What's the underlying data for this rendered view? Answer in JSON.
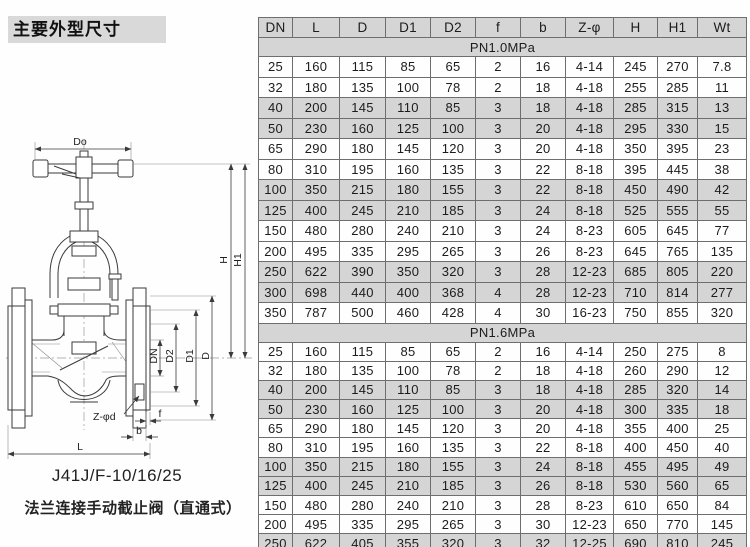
{
  "page": {
    "title": "主要外型尺寸"
  },
  "drawing": {
    "model": "J41J/F-10/16/25",
    "caption": "法兰连接手动截止阀（直通式）",
    "labels": {
      "do": "Do",
      "h": "H",
      "h1": "H1",
      "dn": "DN",
      "d2": "D2",
      "d1": "D1",
      "d": "D",
      "z_phi_d": "Z-φd",
      "f": "f",
      "b": "b",
      "l": "L"
    }
  },
  "table": {
    "columns": [
      "DN",
      "L",
      "D",
      "D1",
      "D2",
      "f",
      "b",
      "Z-φ",
      "H",
      "H1",
      "Wt"
    ],
    "sections": [
      {
        "label": "PN1.0MPa",
        "rows": [
          [
            "25",
            "160",
            "115",
            "85",
            "65",
            "2",
            "16",
            "4-14",
            "245",
            "270",
            "7.8"
          ],
          [
            "32",
            "180",
            "135",
            "100",
            "78",
            "2",
            "18",
            "4-18",
            "255",
            "285",
            "11"
          ],
          [
            "40",
            "200",
            "145",
            "110",
            "85",
            "3",
            "18",
            "4-18",
            "285",
            "315",
            "13"
          ],
          [
            "50",
            "230",
            "160",
            "125",
            "100",
            "3",
            "20",
            "4-18",
            "295",
            "330",
            "15"
          ],
          [
            "65",
            "290",
            "180",
            "145",
            "120",
            "3",
            "20",
            "4-18",
            "350",
            "395",
            "23"
          ],
          [
            "80",
            "310",
            "195",
            "160",
            "135",
            "3",
            "22",
            "8-18",
            "395",
            "445",
            "38"
          ],
          [
            "100",
            "350",
            "215",
            "180",
            "155",
            "3",
            "22",
            "8-18",
            "450",
            "490",
            "42"
          ],
          [
            "125",
            "400",
            "245",
            "210",
            "185",
            "3",
            "24",
            "8-18",
            "525",
            "555",
            "55"
          ],
          [
            "150",
            "480",
            "280",
            "240",
            "210",
            "3",
            "24",
            "8-23",
            "605",
            "645",
            "77"
          ],
          [
            "200",
            "495",
            "335",
            "295",
            "265",
            "3",
            "26",
            "8-23",
            "645",
            "765",
            "135"
          ],
          [
            "250",
            "622",
            "390",
            "350",
            "320",
            "3",
            "28",
            "12-23",
            "685",
            "805",
            "220"
          ],
          [
            "300",
            "698",
            "440",
            "400",
            "368",
            "4",
            "28",
            "12-23",
            "710",
            "814",
            "277"
          ],
          [
            "350",
            "787",
            "500",
            "460",
            "428",
            "4",
            "30",
            "16-23",
            "750",
            "855",
            "320"
          ]
        ]
      },
      {
        "label": "PN1.6MPa",
        "rows": [
          [
            "25",
            "160",
            "115",
            "85",
            "65",
            "2",
            "16",
            "4-14",
            "250",
            "275",
            "8"
          ],
          [
            "32",
            "180",
            "135",
            "100",
            "78",
            "2",
            "18",
            "4-18",
            "260",
            "290",
            "12"
          ],
          [
            "40",
            "200",
            "145",
            "110",
            "85",
            "3",
            "18",
            "4-18",
            "285",
            "320",
            "14"
          ],
          [
            "50",
            "230",
            "160",
            "125",
            "100",
            "3",
            "20",
            "4-18",
            "300",
            "335",
            "18"
          ],
          [
            "65",
            "290",
            "180",
            "145",
            "120",
            "3",
            "20",
            "4-18",
            "355",
            "400",
            "25"
          ],
          [
            "80",
            "310",
            "195",
            "160",
            "135",
            "3",
            "22",
            "8-18",
            "400",
            "450",
            "40"
          ],
          [
            "100",
            "350",
            "215",
            "180",
            "155",
            "3",
            "24",
            "8-18",
            "455",
            "495",
            "49"
          ],
          [
            "125",
            "400",
            "245",
            "210",
            "185",
            "3",
            "26",
            "8-18",
            "530",
            "560",
            "65"
          ],
          [
            "150",
            "480",
            "280",
            "240",
            "210",
            "3",
            "28",
            "8-23",
            "610",
            "650",
            "84"
          ],
          [
            "200",
            "495",
            "335",
            "295",
            "265",
            "3",
            "30",
            "12-23",
            "650",
            "770",
            "145"
          ],
          [
            "250",
            "622",
            "405",
            "355",
            "320",
            "3",
            "32",
            "12-25",
            "690",
            "810",
            "245"
          ],
          [
            "300",
            "698",
            "460",
            "410",
            "375",
            "4",
            "34",
            "12-25",
            "730",
            "845",
            "295"
          ]
        ]
      }
    ]
  },
  "colors": {
    "title_bg": "#d9d9d9",
    "table_shade": "#d5d5d5",
    "table_line": "#6e6e6e",
    "ink": "#1c1c1c"
  }
}
